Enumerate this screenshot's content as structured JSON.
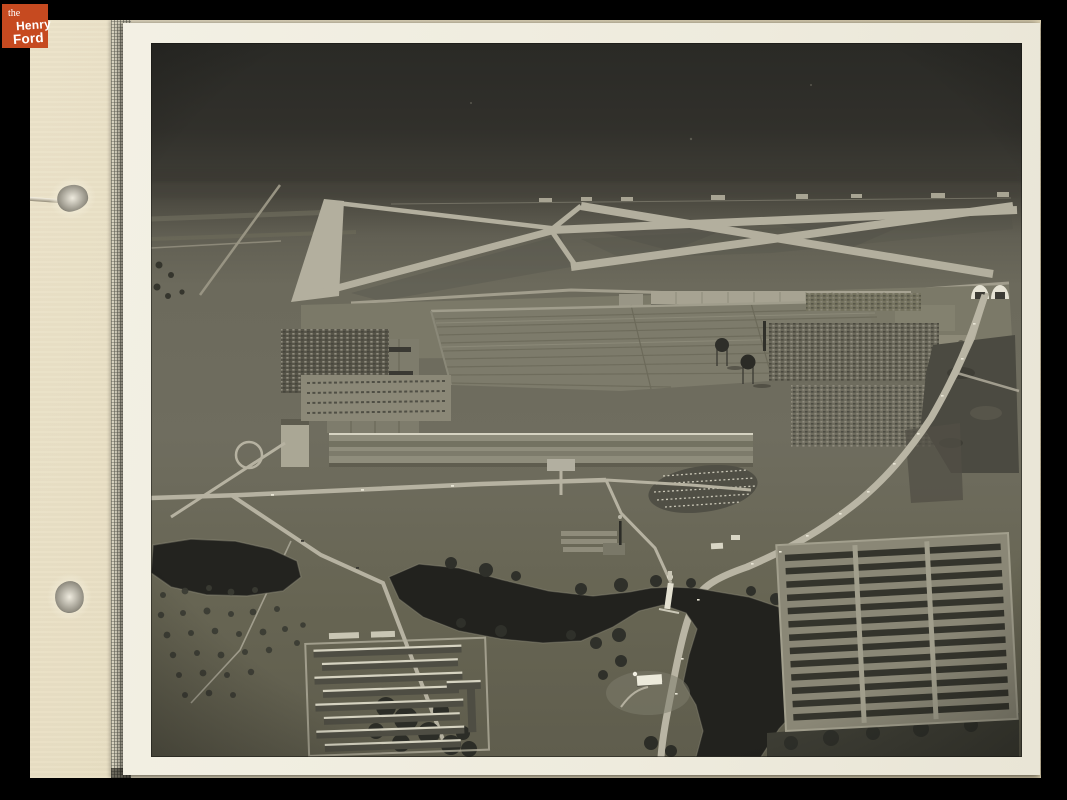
{
  "brand": {
    "line1": "the",
    "line2": "Henry",
    "line3": "Ford",
    "logo_background": "#c64a20",
    "logo_text_color": "#ffffff"
  },
  "scan": {
    "background_color": "#000000",
    "album_page_color": "#e4dabd",
    "binding_strip_color": "#b7b3a1",
    "photo_paper_color": "#f1eee2",
    "photo_description": "Black-and-white aerial photograph mounted on a cream album page with two punch holes. It shows a huge wartime factory complex with a long front building, an airfield of crossing runways behind it, crowded car parking lots, two spherical water towers, twin arch hangars, a highway curving to the foreground, ponds and a winding river, rows of barracks at lower left and a dense grid of trailer rows at lower right, with a small white church on a riverside lawn."
  }
}
